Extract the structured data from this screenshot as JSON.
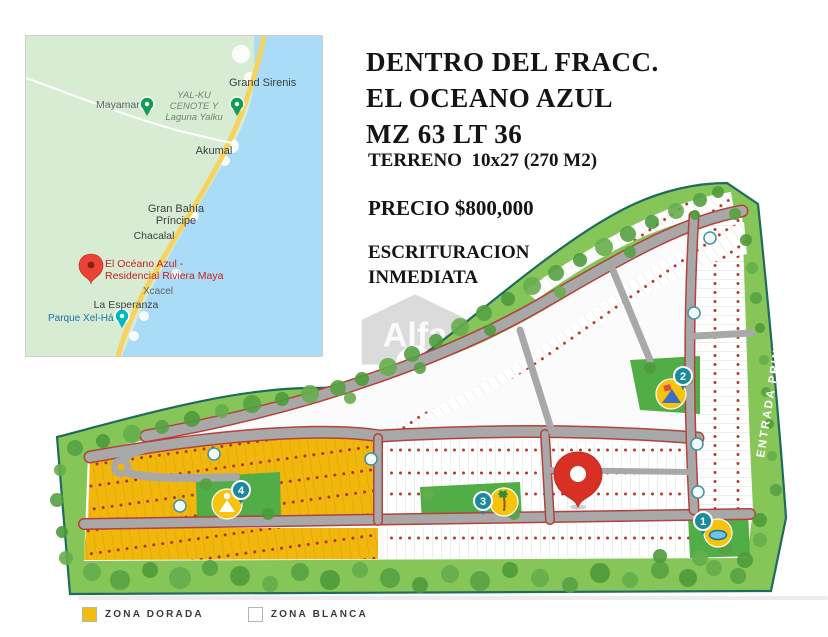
{
  "header": {
    "title_line1": "DENTRO DEL FRACC.",
    "title_line2": "EL OCEANO AZUL",
    "title_line3": "MZ 63 LT 36",
    "terreno": "TERRENO  10x27 (270 M2)",
    "precio": "PRECIO $800,000",
    "escrituracion_line1": "ESCRITURACION",
    "escrituracion_line2": "INMEDIATA"
  },
  "watermark": {
    "brand": "Alfa"
  },
  "inset_map": {
    "labels": {
      "grand_sirenis": "Grand Sirenis",
      "mayamar": "Mayamar",
      "yalku_line1": "YAL-KU",
      "yalku_line2": "CENOTE Y",
      "yalku_line3": "Laguna Yalku",
      "akumal": "Akumal",
      "bahia_line1": "Gran Bahía",
      "bahia_line2": "Príncipe",
      "chacalal": "Chacalal",
      "oceano_line1": "El Océano Azul -",
      "oceano_line2": "Residencial Riviera Maya",
      "xcacel": "Xcacel",
      "la_esperanza": "La Esperanza",
      "xelha": "Parque Xel-Há"
    }
  },
  "site_plan": {
    "entrance_label": "ENTRADA PRINCIPAL",
    "markers": [
      {
        "number": "1",
        "amenity": "pool-icon"
      },
      {
        "number": "2",
        "amenity": "playground-icon"
      },
      {
        "number": "3",
        "amenity": "palm-icon"
      },
      {
        "number": "4",
        "amenity": "yoga-icon"
      }
    ]
  },
  "legend": {
    "items": [
      {
        "label": "ZONA DORADA",
        "color": "#F2BE0D"
      },
      {
        "label": "ZONA BLANCA",
        "color": "#FFFFFF"
      }
    ]
  },
  "colors": {
    "zona_dorada": "#F1B70C",
    "zona_blanca": "#FFFFFF",
    "perimeter_green": "#86C557",
    "park_green": "#51AD45",
    "boundary_teal": "#1F6B5F",
    "road_gray": "#A8A8A8",
    "road_edge_red": "#B5413A",
    "marker_teal": "#1A8A9D",
    "amenity_yellow": "#F6C40E",
    "pin_red": "#D93025",
    "map_water": "#AADCF7",
    "map_land": "#D7ECD3",
    "map_road_yellow": "#F6D35E",
    "map_label_red": "#C5221F",
    "map_label_blue": "#1A73A8"
  }
}
